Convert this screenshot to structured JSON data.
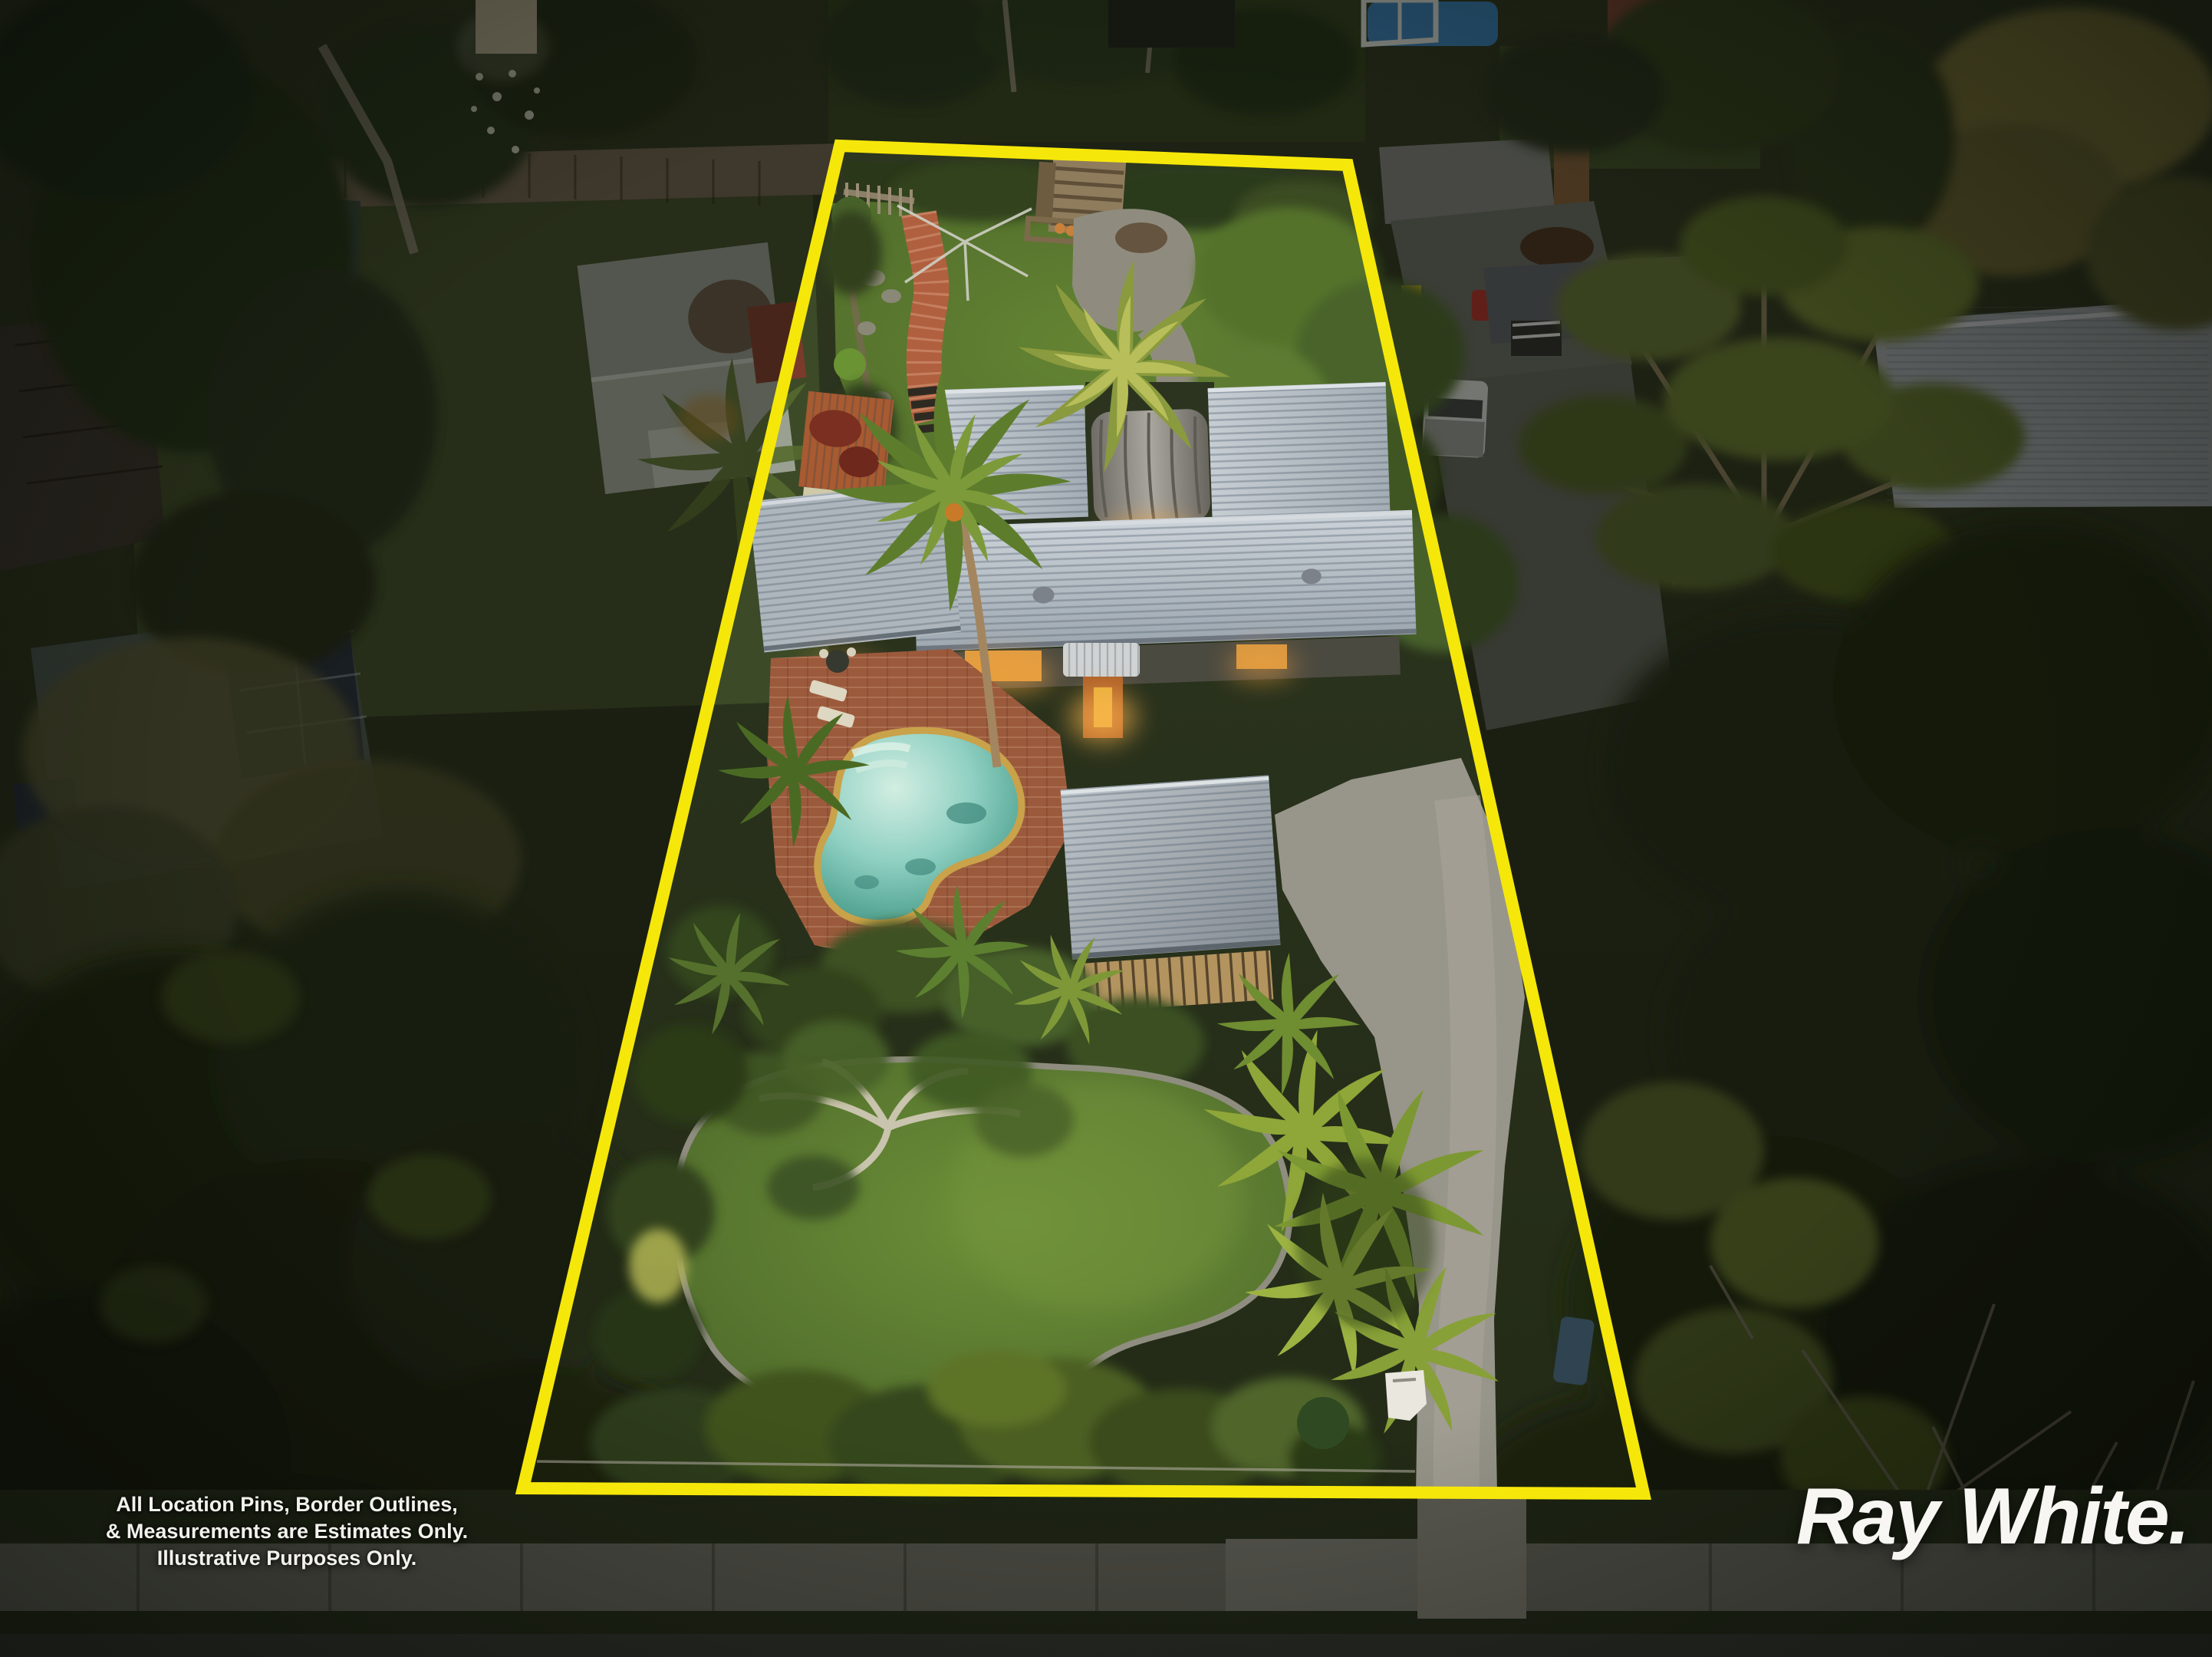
{
  "photo": {
    "palette": {
      "boundary_yellow": "#f6e70a",
      "pool_water": "#7cc7b9",
      "pool_coping_tan": "#c9a24a",
      "lawn_green": "#5e8032",
      "roof_grey": "#bcc4cb",
      "brick_patio": "#9c5a3c",
      "gravel_grey": "#98958a",
      "dusk_foliage": "#2b3619",
      "window_glow": "#f0a23c"
    }
  },
  "overlay": {
    "disclaimer": {
      "line1": "All Location Pins, Border Outlines,",
      "line2": "& Measurements are Estimates Only.",
      "line3": "Illustrative Purposes Only."
    },
    "brand": {
      "name": "Ray White."
    }
  }
}
